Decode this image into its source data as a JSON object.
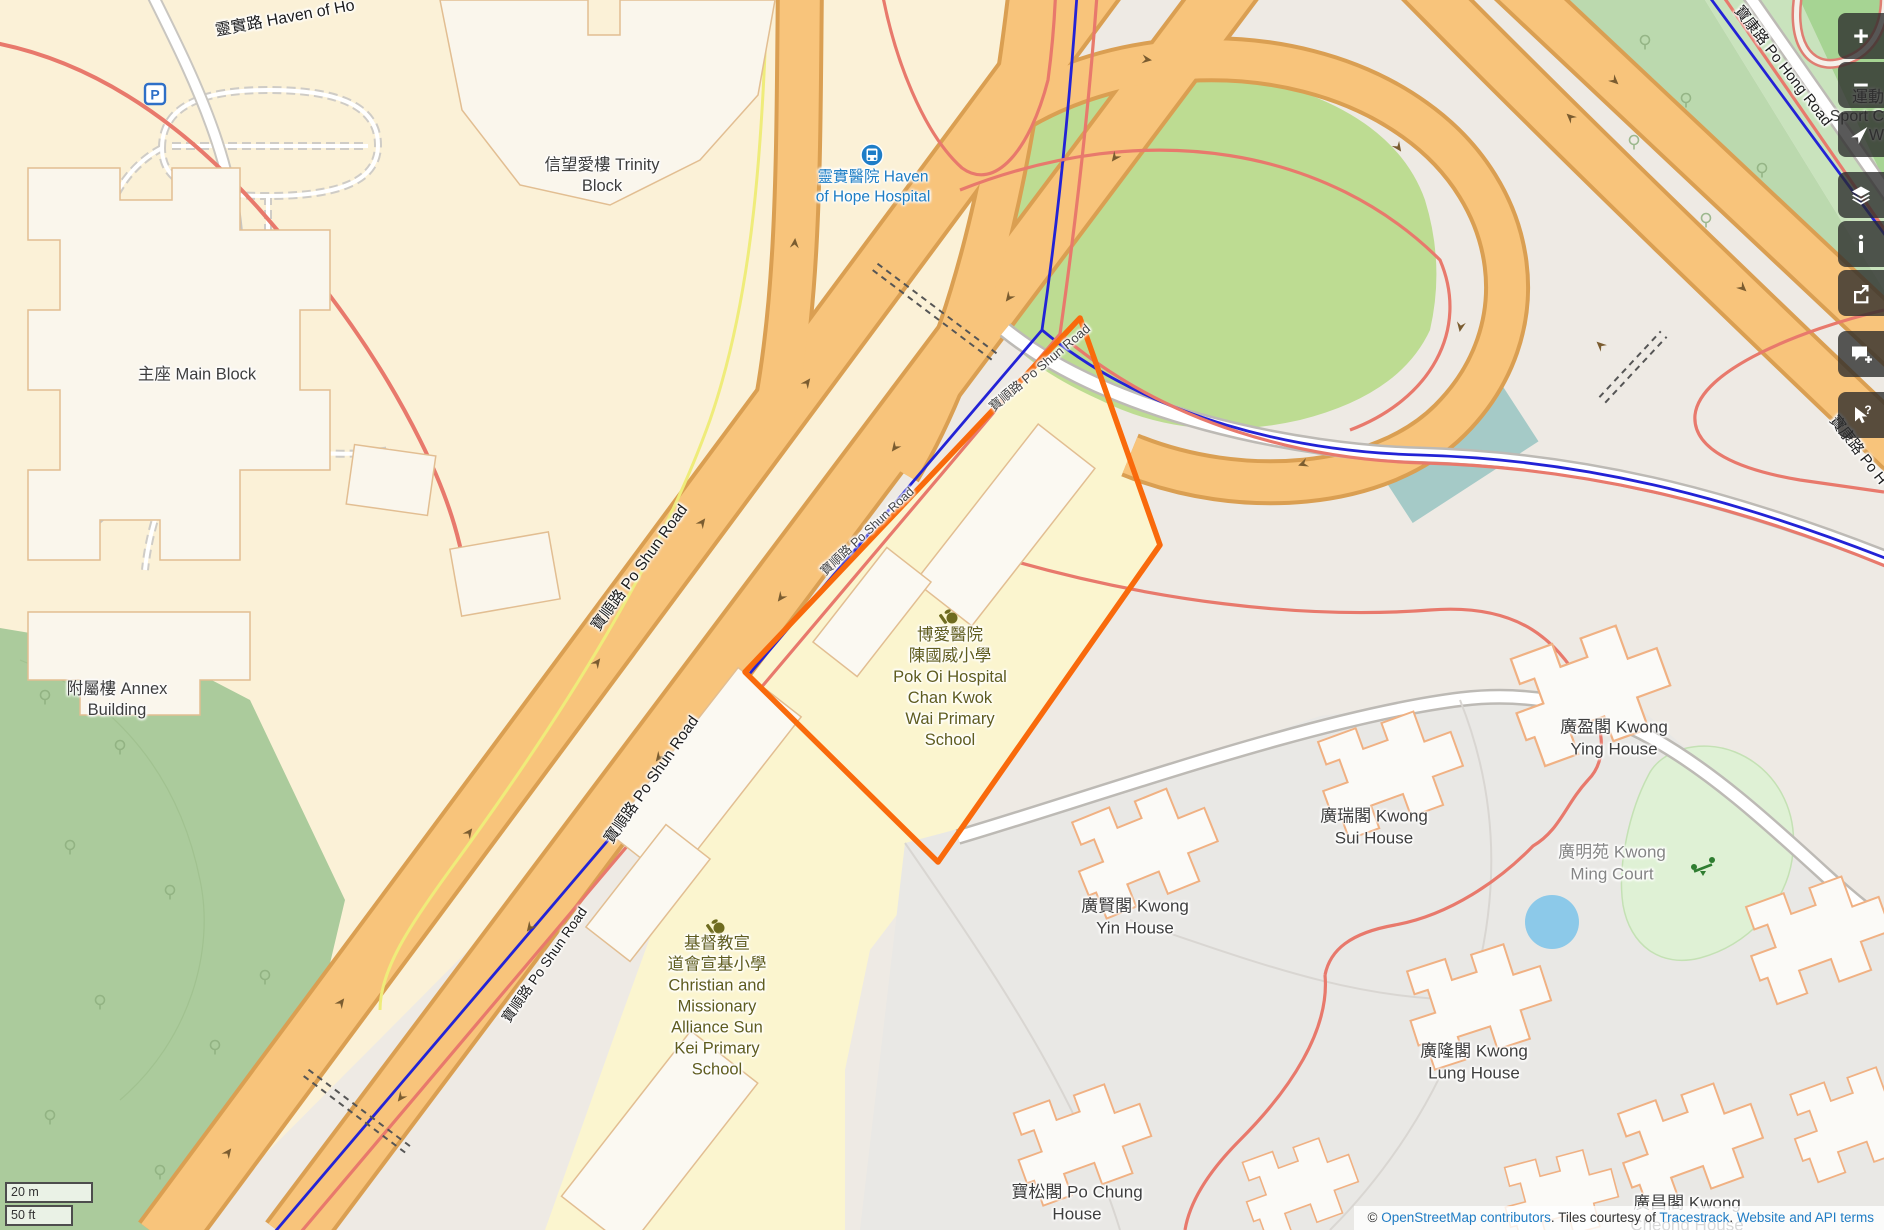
{
  "attribution": {
    "copyright": "©",
    "link_osm": "OpenStreetMap contributors",
    "middle": ". Tiles courtesy of ",
    "link_tracestrack": "Tracestrack",
    "sep": ". ",
    "link_terms": "Website and API terms"
  },
  "scalebar": {
    "metric": "20 m",
    "imperial": "50 ft"
  },
  "controls": {
    "zoom_in": "+",
    "zoom_out": "−"
  },
  "roads": {
    "haven_of_hope_road": "靈實路 Haven of Ho",
    "po_shun_road": "寶順路 Po Shun Road",
    "po_hong_road": "寶康路 Po Hong Road",
    "po_hong_road_short": "寶康路 Po H"
  },
  "places": {
    "trinity": {
      "l1": "信望愛樓 Trinity",
      "l2": "Block"
    },
    "main_block": {
      "l1": "主座 Main Block"
    },
    "annex": {
      "l1": "附屬樓 Annex",
      "l2": "Building"
    },
    "hoh_hospital": {
      "l1": "靈實醫院 Haven",
      "l2": "of Hope Hospital"
    },
    "pok_oi_school": {
      "l1": "博愛醫院",
      "l2": "陳國威小學",
      "l3": "Pok Oi Hospital",
      "l4": "Chan Kwok",
      "l5": "Wai Primary",
      "l6": "School"
    },
    "sun_kei_school": {
      "l1": "基督教宣",
      "l2": "道會宣基小學",
      "l3": "Christian and",
      "l4": "Missionary",
      "l5": "Alliance Sun",
      "l6": "Kei Primary",
      "l7": "School"
    },
    "kwong_ying": {
      "l1": "廣盈閣 Kwong",
      "l2": "Ying House"
    },
    "kwong_sui": {
      "l1": "廣瑞閣 Kwong",
      "l2": "Sui House"
    },
    "kwong_ming": {
      "l1": "廣明苑 Kwong",
      "l2": "Ming Court"
    },
    "kwong_yin": {
      "l1": "廣賢閣 Kwong",
      "l2": "Yin House"
    },
    "kwong_lung": {
      "l1": "廣隆閣 Kwong",
      "l2": "Lung House"
    },
    "po_chung": {
      "l1": "寶松閣 Po Chung",
      "l2": "House"
    },
    "kwong_cheong": {
      "l1": "廣昌閣 Kwong",
      "l2": "Cheong House"
    },
    "kwong_ning": {
      "l1": "廣寧閣",
      "l2": "Ning"
    },
    "sport_centre": {
      "l1": "運動",
      "l2": "Sport C",
      "l3": "W"
    },
    "parking_symbol": "P"
  },
  "colors": {
    "selection_orange": "#F96A0C",
    "trunk_road_fill": "#F8C47B",
    "trunk_road_casing": "#DA9F52",
    "cycle_route_blue": "#2323D6",
    "bus_route_salmon": "#E8796C",
    "transit_label_blue": "#1D7DC4",
    "link_blue": "#1F7CC4",
    "ground_cream": "#FBF1D7",
    "school_yellow": "#FBF5CF",
    "forest_green": "#ABCB9C",
    "roundabout_green": "#BDDC92",
    "pond_blue": "#8CC9E9"
  }
}
